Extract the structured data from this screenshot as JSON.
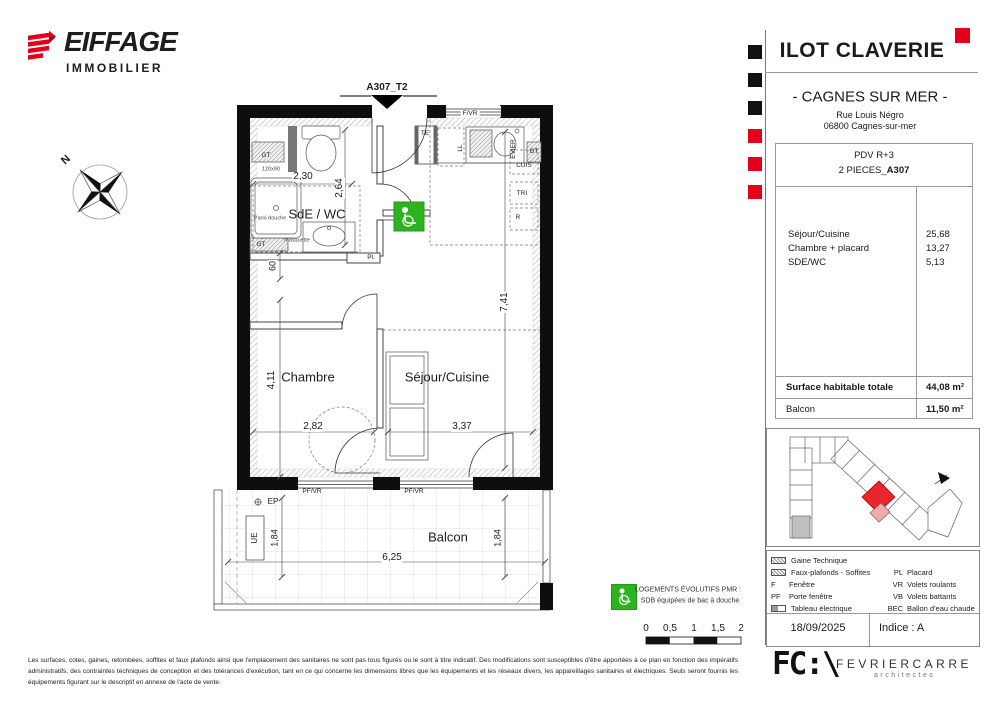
{
  "brand": {
    "name": "EIFFAGE",
    "sub": "IMMOBILIER"
  },
  "title_block": {
    "project": "ILOT CLAVERIE",
    "city": "- CAGNES SUR MER -",
    "address_line1": "Rue Louis Négro",
    "address_line2": "06800 Cagnes-sur-mer"
  },
  "unit_info": {
    "level": "PDV R+3",
    "type_prefix": "2 PIECES_",
    "unit_id": "A307",
    "rooms": [
      {
        "label": "Séjour/Cuisine",
        "area": "25,68"
      },
      {
        "label": "Chambre + placard",
        "area": "13,27"
      },
      {
        "label": "SDE/WC",
        "area": "5,13"
      }
    ],
    "totals": [
      {
        "label": "Surface habitable totale",
        "area": "44,08 m²"
      },
      {
        "label": "Balcon",
        "area": "11,50 m²"
      }
    ]
  },
  "legend": {
    "gt_icon_label": "GT",
    "rows_left": [
      {
        "label": "Gaine Technique"
      },
      {
        "label": "Faux-plafonds - Soffites"
      },
      {
        "abbr": "F",
        "label": "Fenêtre"
      },
      {
        "abbr": "PF",
        "label": "Porte fenêtre"
      },
      {
        "label": "Tableau électrique"
      }
    ],
    "rows_right": [
      {
        "abbr": "PL",
        "label": "Placard"
      },
      {
        "abbr": "VR",
        "label": "Volets roulants"
      },
      {
        "abbr": "VB",
        "label": "Volets battants"
      },
      {
        "abbr": "BEC",
        "label": "Ballon d'eau chaude"
      }
    ]
  },
  "revision": {
    "date": "18/09/2025",
    "indice": "Indice : A"
  },
  "pmr_note": {
    "line1": "LOGEMENTS ÉVOLUTIFS PMR :",
    "line2": "SDB équipées de bac à douche"
  },
  "scale_bar": {
    "labels": [
      "0",
      "0,5",
      "1",
      "1,5",
      "2"
    ]
  },
  "plan": {
    "entrance": "A307_T2",
    "north": "N",
    "rooms": {
      "sde": "SdE / WC",
      "chambre": "Chambre",
      "sejour": "Séjour/Cuisine",
      "balcon": "Balcon"
    },
    "labels": {
      "fvr": "F/VR",
      "pfvr1": "PF/VR",
      "pfvr2": "PF/VR",
      "te": "TE",
      "ll": "LL",
      "evier": "EVIER",
      "cuis": "CUIS",
      "tri": "TRI",
      "r": "R",
      "gt_top_left": "GT",
      "gt_bottom_left": "GT",
      "gt_top_right": "GT",
      "shower_size": "120x90",
      "paroi": "Paroi douche",
      "masquette": "masquette",
      "pl": "Pl.",
      "ep": "EP",
      "ue": "UE"
    },
    "dims": {
      "sde_width": "2,30",
      "sde_depth": "2,64",
      "hall": "60",
      "chambre_depth": "4,11",
      "chambre_width": "2,82",
      "sejour_width": "3,37",
      "sejour_depth": "7,41",
      "balcon_depth_left": "1,84",
      "balcon_depth_right": "1,84",
      "balcon_width": "6,25"
    }
  },
  "disclaimer": "Les surfaces, cotes, gaines, retombées, soffites et faux plafonds ainsi que l'emplacement des sanitaires ne sont pas tous figurés ou le sont à titre indicatif. Des modifications sont susceptibles d'être apportées à ce plan en fonction des impératifs administratifs, des contraintes techniques de conception et des tolérances d'exécution, tant en ce qui concerne les dimensions libres que les équipements et les réseaux divers, les appareillages sanitaires et électriques. Seuls seront fournis les équipements figurant sur le descriptif en annexe de l'acte de vente.",
  "architect": {
    "logo": "FC:\\",
    "name": "FEVRIERCARRE",
    "sub": "architectes"
  },
  "colors": {
    "accent_red": "#e2001a",
    "pmr_green": "#2eb320",
    "unit_red": "#e8262b"
  }
}
